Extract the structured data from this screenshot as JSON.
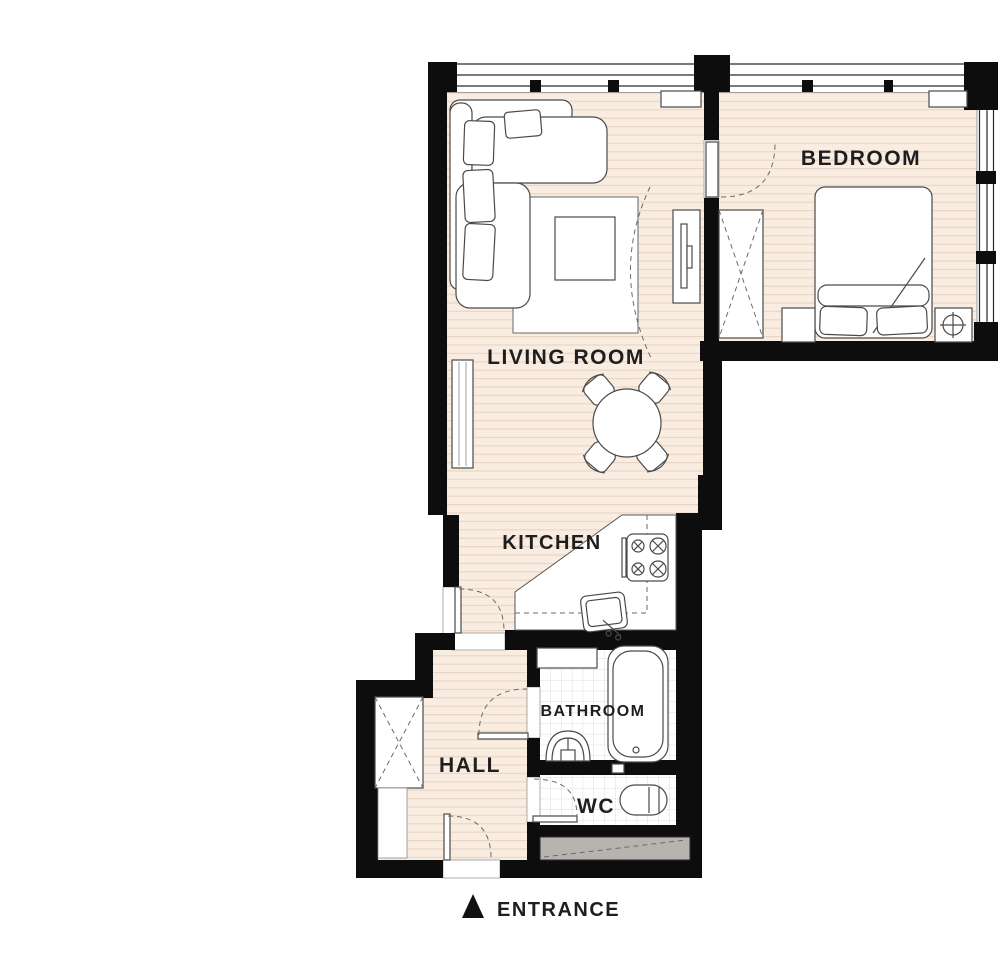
{
  "title": "Apartment floor plan",
  "rooms": {
    "living_room": {
      "label": "LIVING ROOM"
    },
    "bedroom": {
      "label": "BEDROOM"
    },
    "kitchen": {
      "label": "KITCHEN"
    },
    "hall": {
      "label": "HALL"
    },
    "bathroom": {
      "label": "BATHROOM"
    },
    "wc": {
      "label": "WC"
    }
  },
  "entrance": {
    "label": "ENTRANCE",
    "marker_icon": "triangle-up-icon"
  },
  "colors": {
    "wall": "#0d0d0d",
    "floor_fill": "#f9ece1",
    "floor_line": "#e8d4c2",
    "tile_line": "#dcdcdc",
    "shaft_fill": "#b7b4b0",
    "furniture_stroke": "#4a4a4a",
    "label_ink": "#1e1e1e"
  }
}
